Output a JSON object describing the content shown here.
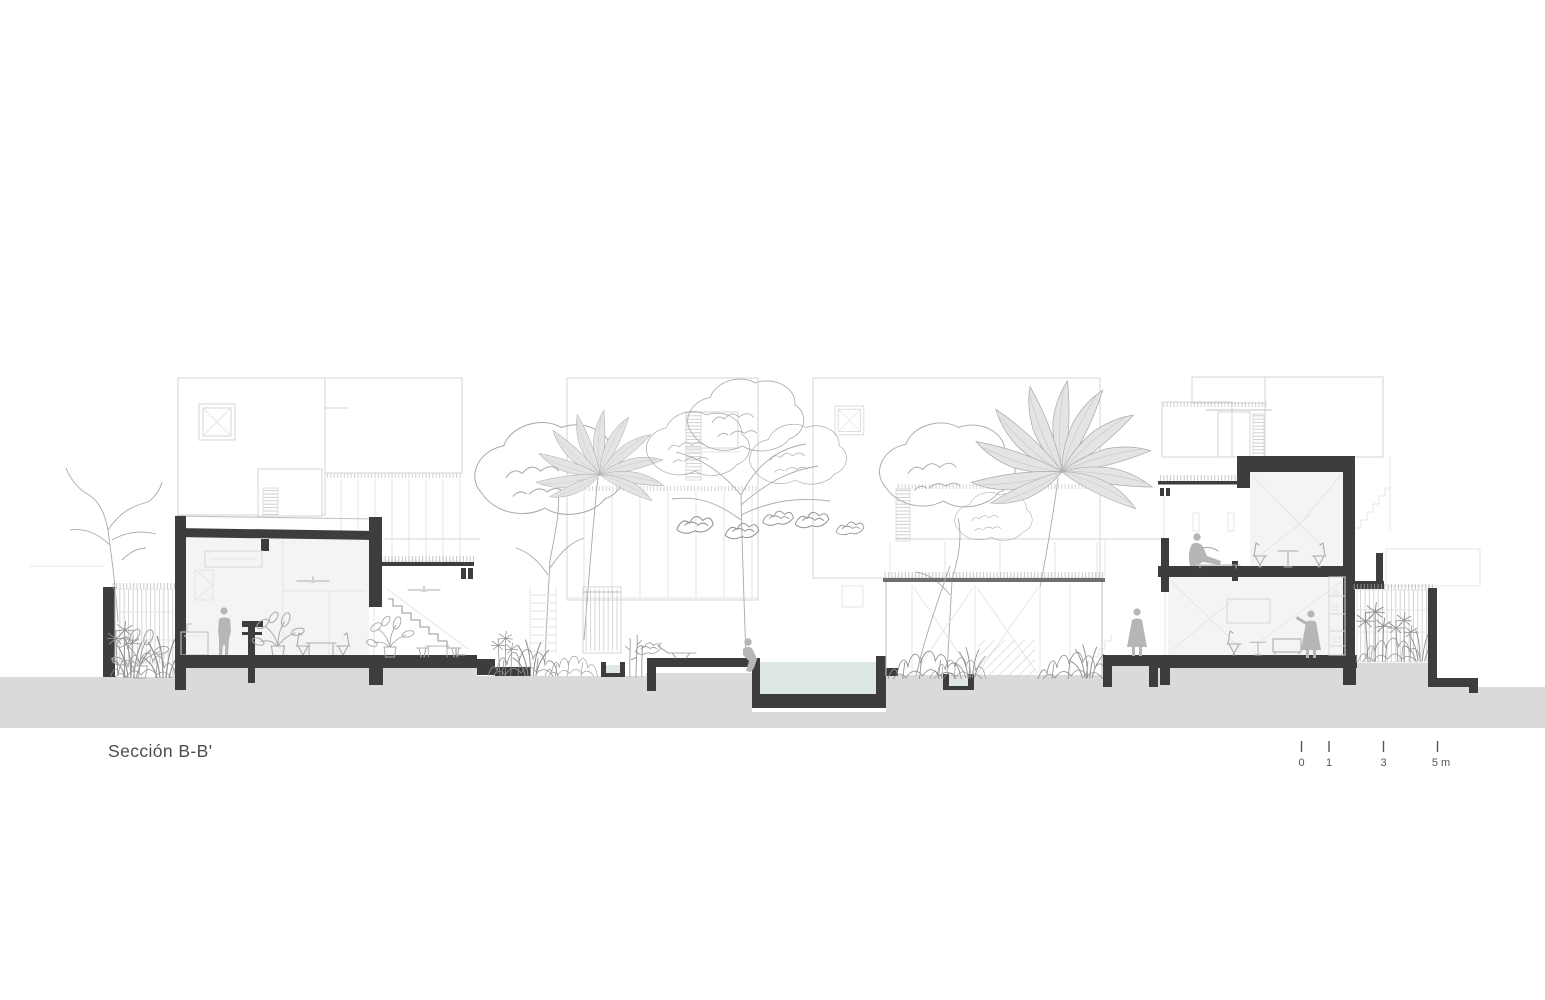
{
  "drawing": {
    "title": "Sección B-B'",
    "scale_bar": {
      "tick_labels": [
        "0",
        "1",
        "3",
        "5 m"
      ]
    }
  },
  "colors": {
    "cut": "#3d3d3d",
    "ground": "#dadada",
    "interior": "#f4f4f4",
    "water": "#dde7e3",
    "facade": "#d6d6d6",
    "facade-dark": "#c0c0c0",
    "furniture": "#adadad",
    "veg": "#a9a9a9",
    "veg-dark": "#8f8f8f",
    "palm": "#e4e4e4",
    "figure": "#b6b6b6",
    "faint": "#e4e4e4",
    "text": "#4d4d4d"
  },
  "scene": {
    "elements": [
      "left-house-section",
      "left-courtyard-fence",
      "kitchen-counter",
      "kitchen-island",
      "dining-table",
      "ceiling-fan",
      "terrace-stair",
      "courtyard-gate",
      "planter-basin",
      "swimming-pool",
      "pool-deck",
      "lounge-chair",
      "water-channel",
      "garden-pavilion",
      "right-house-section",
      "tv-screen",
      "shelf-unit",
      "entry-platform",
      "right-courtyard-fence",
      "palm-tree",
      "canopy-tree",
      "bare-tree",
      "shrubs"
    ],
    "figures": [
      "standing-man-kitchen",
      "bather-at-pool-edge",
      "standing-woman-entry",
      "seated-person-upper-terrace",
      "standing-woman-living-room"
    ]
  }
}
